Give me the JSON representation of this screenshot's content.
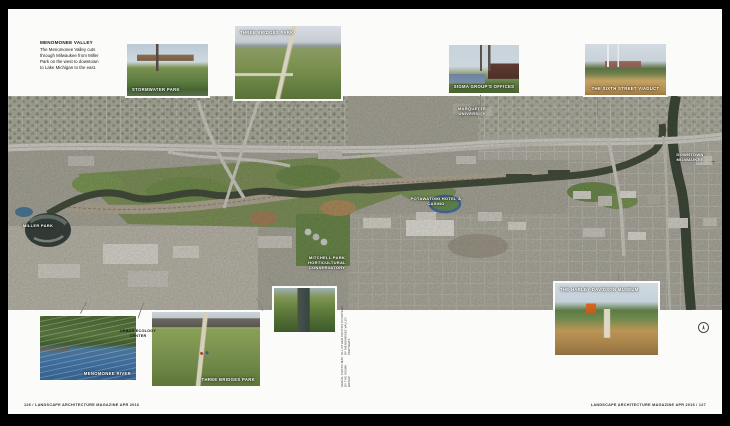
{
  "intro": {
    "title": "MENOMONEE VALLEY",
    "body": "The Menomonee Valley cuts through Milwaukee from Miller Park on the west to downtown to Lake Michigan to the east."
  },
  "photos": {
    "stormwater": {
      "label": "STORMWATER PARK"
    },
    "three_bridges_top": {
      "label": "THREE BRIDGES PARK"
    },
    "sigma": {
      "label": "SIGMA GROUP'S OFFICES"
    },
    "viaduct": {
      "label": "THE SIXTH STREET VIADUCT"
    },
    "menomonee_river": {
      "label": "MENOMONEE RIVER"
    },
    "three_bridges_bottom": {
      "label": "THREE BRIDGES PARK"
    },
    "harley": {
      "label": "THE HARLEY-DAVIDSON MUSEUM"
    }
  },
  "map_labels": {
    "miller_park": "MILLER PARK",
    "marquette": "MARQUETTE UNIVERSITY",
    "potawatomi": "POTAWATOMI HOTEL & CASINO",
    "mitchell_park": "MITCHELL PARK HORTICULTURAL CONSERVATORY",
    "downtown": "DOWNTOWN MILWAUKEE",
    "urban_ecology": "URBAN ECOLOGY CENTER"
  },
  "icons": {
    "arrow_right": "→"
  },
  "credit": {
    "line1": "AERIAL PHOTO MAP BY THE SIGMA GROUP",
    "line2": "ALL OTHER PHOTOS COURTESY OF MENOMONEE VALLEY PARTNERS"
  },
  "footer": {
    "left": "126 / LANDSCAPE ARCHITECTURE MAGAZINE APR 2016",
    "right": "LANDSCAPE ARCHITECTURE MAGAZINE APR 2016 / 127"
  },
  "colors": {
    "map_base": "#aaa89b",
    "river": "#454f3d",
    "valley_green": "#75904f",
    "page": "#fbfbf9"
  }
}
